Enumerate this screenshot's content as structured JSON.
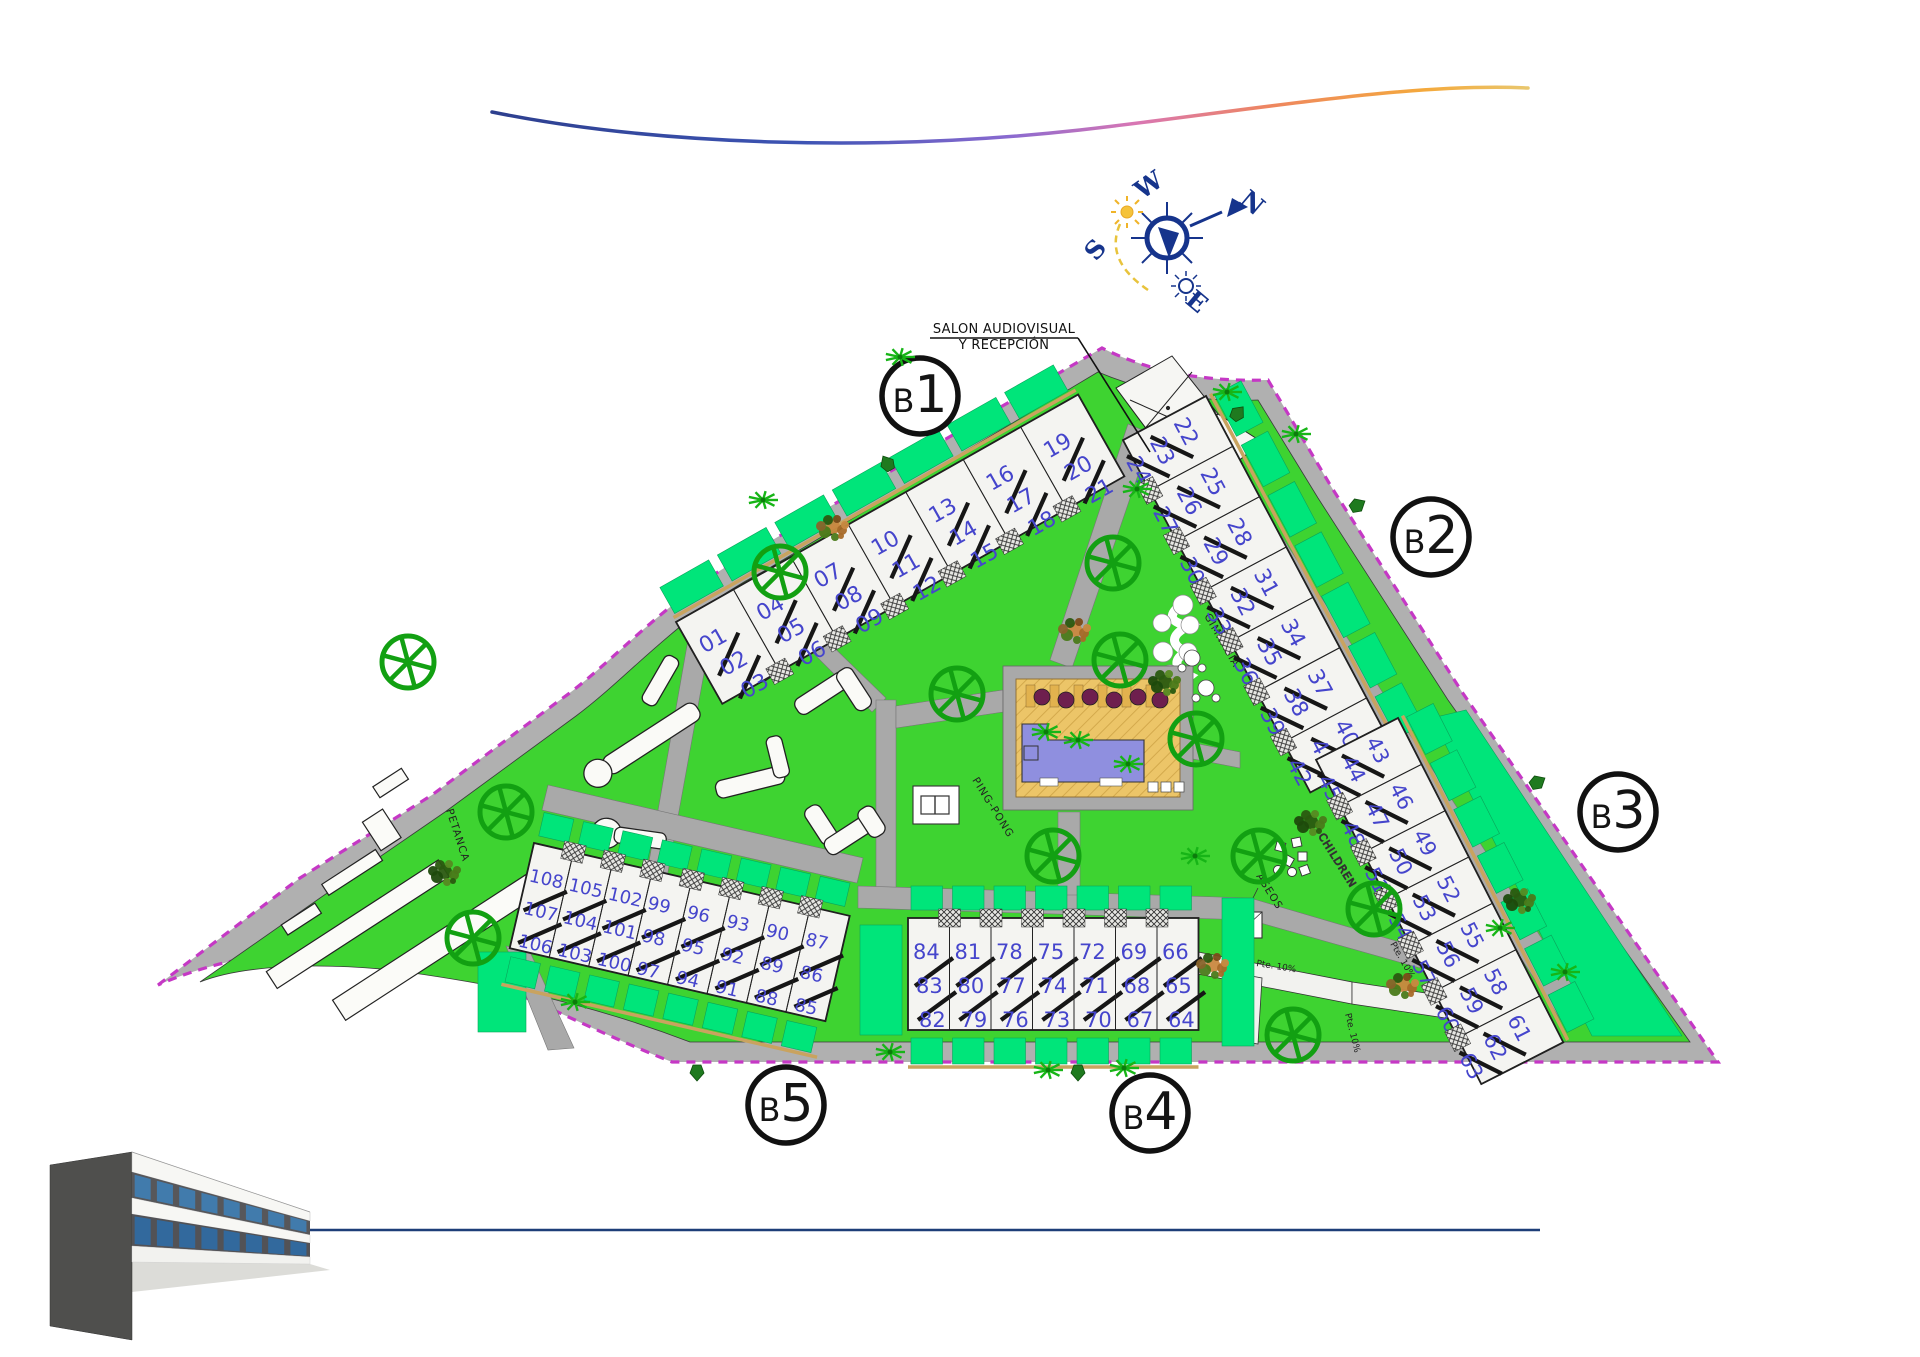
{
  "compass": {
    "north": "N",
    "south": "S",
    "east": "E",
    "west": "W"
  },
  "annotations": {
    "reception_label_line1": "SALON AUDIOVISUAL",
    "reception_label_line2": "Y RECEPCIÓN"
  },
  "amenities": {
    "petanca": "PETANCA",
    "gimnasia": "GIMNASIA",
    "ping_pong": "PING-PONG",
    "children": "CHILDREN",
    "aseos": "ASEOS"
  },
  "ramp_label": "Pte. 10%",
  "blocks": [
    {
      "id": "b1",
      "label": "B1",
      "units": [
        [
          "01",
          "02",
          "03"
        ],
        [
          "04",
          "05",
          "06"
        ],
        [
          "07",
          "08",
          "09"
        ],
        [
          "10",
          "11",
          "12"
        ],
        [
          "13",
          "14",
          "15"
        ],
        [
          "16",
          "17",
          "18"
        ],
        [
          "19",
          "20",
          "21"
        ]
      ]
    },
    {
      "id": "b2",
      "label": "B2",
      "units": [
        [
          "22",
          "23",
          "24"
        ],
        [
          "25",
          "26",
          "27"
        ],
        [
          "28",
          "29",
          "30"
        ],
        [
          "31",
          "32",
          "33"
        ],
        [
          "34",
          "35",
          "36"
        ],
        [
          "37",
          "38",
          "39"
        ],
        [
          "40",
          "41",
          "42"
        ]
      ]
    },
    {
      "id": "b3",
      "label": "B3",
      "units": [
        [
          "43",
          "44",
          "45"
        ],
        [
          "46",
          "47",
          "48"
        ],
        [
          "49",
          "50",
          "51"
        ],
        [
          "52",
          "53",
          "54"
        ],
        [
          "55",
          "56",
          "57"
        ],
        [
          "58",
          "59",
          "60"
        ],
        [
          "61",
          "62",
          "63"
        ]
      ]
    },
    {
      "id": "b4",
      "label": "B4",
      "units": [
        [
          "84",
          "83",
          "82"
        ],
        [
          "81",
          "80",
          "79"
        ],
        [
          "78",
          "77",
          "76"
        ],
        [
          "75",
          "74",
          "73"
        ],
        [
          "72",
          "71",
          "70"
        ],
        [
          "69",
          "68",
          "67"
        ],
        [
          "66",
          "65",
          "64"
        ]
      ]
    },
    {
      "id": "b5",
      "label": "B5",
      "units": [
        [
          "108",
          "107",
          "106"
        ],
        [
          "105",
          "104",
          "103"
        ],
        [
          "102",
          "101",
          "100"
        ],
        [
          "99",
          "98",
          "97"
        ],
        [
          "96",
          "95",
          "94"
        ],
        [
          "93",
          "92",
          "91"
        ],
        [
          "90",
          "89",
          "88"
        ],
        [
          "87",
          "86",
          "85"
        ]
      ]
    }
  ],
  "colors": {
    "lawn": "#3ed331",
    "garden": "#00e57a",
    "path": "#a9a9a9",
    "boundary": "#c538c5",
    "unit_number": "#4545cc",
    "building": "#f4f4f1",
    "pool_water": "#8f8fdf",
    "pool_deck": "#ecc568",
    "tree": "#12a012",
    "compass_blue": "#16348c",
    "sun_yellow": "#f0b429",
    "footer_line": "#1d3e78"
  }
}
